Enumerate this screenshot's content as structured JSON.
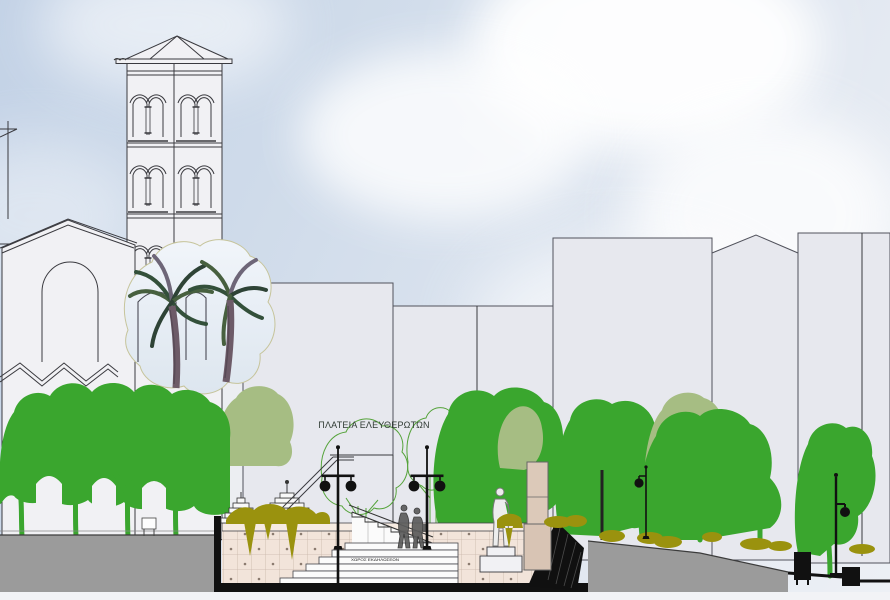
{
  "drawing": {
    "plaza_title": "ΠΛΑΤΕΙΑ ΕΛΕΥΘΕΡΩΤΩΝ",
    "stairs_inscription": "ΧΩΡΟΣ ΕΚΔΗΛΩΣΕΩΝ",
    "scene_elements": [
      "sky with clouds",
      "basilica church facade with arched window and zigzag aisle roof",
      "campanile bell tower with three tiers of bifora windows and pyramid roof",
      "photo-collage palm trees over the drawing",
      "background city buildings",
      "rows of street trees",
      "outline trees on the plaza",
      "plaza name text",
      "glazed-tile retaining wall with planters",
      "stepped cascade sculptures",
      "upper staircase with railing",
      "grand steps with tiny inscription",
      "twin-globe lamp posts",
      "single-globe street lamps",
      "statue on pedestal",
      "memorial pylon",
      "two pedestrians",
      "hanging olive shrubs",
      "asphalt road left",
      "sloping road right",
      "black section-cut of substructure",
      "litter bin",
      "bench kiosk",
      "bird"
    ]
  },
  "palette": {
    "sky_top": "#c3d2e6",
    "sky_bottom": "#edf0f5",
    "cloud_white": "#ffffff",
    "building_fill": "#e7e8ee",
    "building_stroke": "#51525c",
    "drawing_white": "#f1f1f4",
    "line_dark": "#3a3a3f",
    "green_medium": "#3aa62e",
    "green_sage": "#a6bd83",
    "green_outline": "#55a33a",
    "olive": "#9a920e",
    "road_gray": "#9b9b9b",
    "tile_fill": "#f2e4da",
    "tile_line": "#c9b6a9",
    "tile_dot": "#8b7b6f",
    "column_beige": "#dcc9b9",
    "black": "#111111",
    "statue_fill": "#ededed",
    "palm_edge": "#c6c49b",
    "palm_trunk": "#6d5b68"
  }
}
